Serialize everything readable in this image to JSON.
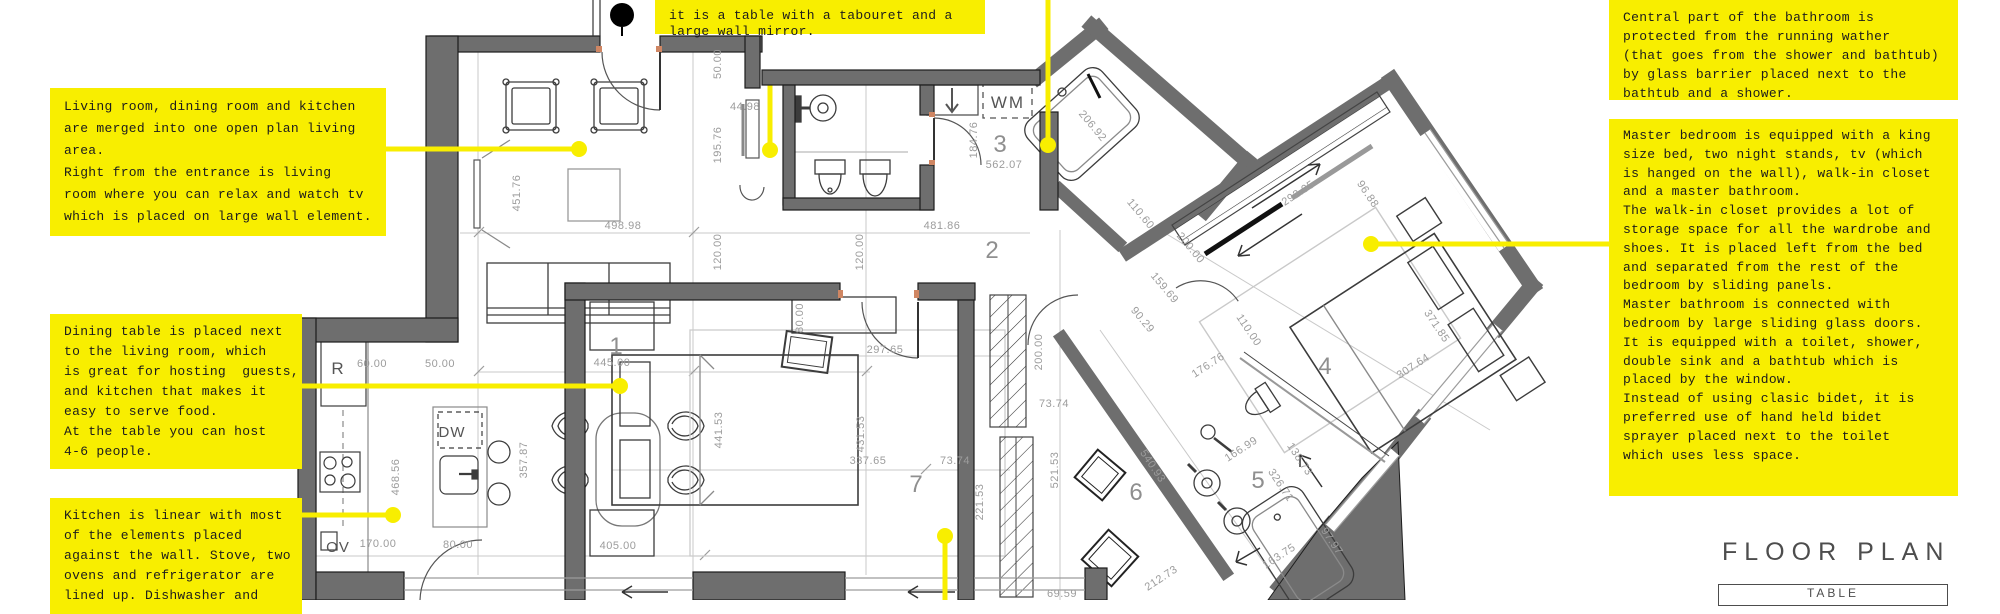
{
  "title": {
    "heading": "FLOOR PLAN",
    "table_header": "TABLE"
  },
  "colors": {
    "note_yellow": "#f8ee00",
    "wall_gray": "#6e6e6e",
    "dim_gray": "#9c9c9c",
    "line_dark": "#1c1c1c"
  },
  "notes": [
    {
      "id": "note-entrance",
      "x": 655,
      "y": 0,
      "w": 330,
      "h": 34,
      "lh": 16,
      "lines": [
        "it is a table with a tabouret and a",
        "large wall mirror."
      ]
    },
    {
      "id": "note-bathroom-glass",
      "x": 1609,
      "y": 0,
      "w": 349,
      "h": 100,
      "lh": 19,
      "lines": [
        "Central part of the bathroom is",
        "protected from the running wather",
        "(that goes from the shower and bathtub)",
        "by glass barrier placed next to the",
        "bathtub and a shower."
      ]
    },
    {
      "id": "note-living-room",
      "x": 50,
      "y": 88,
      "w": 336,
      "h": 148,
      "lh": 22,
      "lines": [
        "Living room, dining room and kitchen",
        "are merged into one open plan living",
        "area.",
        "Right from the entrance is living",
        "room where you can relax and watch tv",
        "which is placed on large wall element."
      ]
    },
    {
      "id": "note-dining-table",
      "x": 50,
      "y": 314,
      "w": 252,
      "h": 155,
      "lh": 20,
      "lines": [
        "Dining table is placed next",
        "to the living room, which",
        "is great for hosting  guests,",
        "and kitchen that makes it",
        "easy to serve food.",
        "At the table you can host",
        "4-6 people."
      ]
    },
    {
      "id": "note-kitchen",
      "x": 50,
      "y": 498,
      "w": 252,
      "h": 116,
      "lh": 20,
      "lines": [
        "Kitchen is linear with most",
        "of the elements placed",
        "against the wall. Stove, two",
        "ovens and refrigerator are",
        "lined up. Dishwasher and"
      ]
    },
    {
      "id": "note-master-bedroom",
      "x": 1609,
      "y": 119,
      "w": 349,
      "h": 377,
      "lh": 18.8,
      "lines": [
        "Master bedroom is equipped with a king",
        "size bed, two night stands, tv (which",
        "is hanged on the wall), walk-in closet",
        "and a master bathroom.",
        "The walk-in closet provides a lot of",
        "storage space for all the wardrobe and",
        "shoes. It is placed left from the bed",
        "and separated from the rest of the",
        "bedroom by sliding panels.",
        "Master bathroom is connected with",
        "bedroom by large sliding glass doors.",
        "It is equipped with a toilet, shower,",
        "double sink and a bathtub which is",
        "placed by the window.",
        "Instead of using clasic bidet, it is",
        "preferred use of hand held bidet",
        "sprayer placed next to the toilet",
        "which uses less space."
      ]
    }
  ],
  "callouts": [
    {
      "id": "callout-living",
      "x1": 386,
      "y1": 149,
      "x2": 579,
      "y2": 149,
      "dot": "end",
      "layer": "over"
    },
    {
      "id": "callout-entrance",
      "x1": 770,
      "y1": 80,
      "x2": 770,
      "y2": 150,
      "dot": "end",
      "layer": "under"
    },
    {
      "id": "callout-bathtub",
      "x1": 1048,
      "y1": 0,
      "x2": 1048,
      "y2": 145,
      "dot": "end",
      "layer": "over"
    },
    {
      "id": "callout-dining",
      "x1": 302,
      "y1": 386,
      "x2": 620,
      "y2": 386,
      "dot": "end",
      "layer": "over"
    },
    {
      "id": "callout-kitchen",
      "x1": 302,
      "y1": 515,
      "x2": 393,
      "y2": 515,
      "dot": "end",
      "layer": "over"
    },
    {
      "id": "callout-master",
      "x1": 1609,
      "y1": 244,
      "x2": 1371,
      "y2": 244,
      "dot": "end",
      "layer": "over"
    },
    {
      "id": "callout-bedroom7",
      "x1": 945,
      "y1": 600,
      "x2": 945,
      "y2": 536,
      "dot": "end",
      "layer": "over"
    }
  ],
  "dimensions": [
    {
      "t": "50.00",
      "x": 721,
      "y": 64,
      "r": -90
    },
    {
      "t": "44.98",
      "x": 745,
      "y": 110,
      "r": 0
    },
    {
      "t": "195.76",
      "x": 721,
      "y": 145,
      "r": -90
    },
    {
      "t": "451.76",
      "x": 520,
      "y": 193,
      "r": -90
    },
    {
      "t": "498.98",
      "x": 623,
      "y": 229,
      "r": 0
    },
    {
      "t": "481.86",
      "x": 942,
      "y": 229,
      "r": 0
    },
    {
      "t": "120.00",
      "x": 721,
      "y": 252,
      "r": -90
    },
    {
      "t": "120.00",
      "x": 863,
      "y": 252,
      "r": -90
    },
    {
      "t": "184.76",
      "x": 977,
      "y": 140,
      "r": -90
    },
    {
      "t": "562.07",
      "x": 1004,
      "y": 168,
      "r": 0
    },
    {
      "t": "206.92",
      "x": 1090,
      "y": 128,
      "r": 50
    },
    {
      "t": "60.00",
      "x": 372,
      "y": 367,
      "r": 0
    },
    {
      "t": "50.00",
      "x": 440,
      "y": 367,
      "r": 0
    },
    {
      "t": "445.00",
      "x": 612,
      "y": 366,
      "r": 0
    },
    {
      "t": "468.56",
      "x": 399,
      "y": 477,
      "r": -90
    },
    {
      "t": "357.87",
      "x": 527,
      "y": 460,
      "r": -90
    },
    {
      "t": "170.00",
      "x": 378,
      "y": 547,
      "r": 0
    },
    {
      "t": "80.00",
      "x": 458,
      "y": 548,
      "r": 0
    },
    {
      "t": "405.00",
      "x": 618,
      "y": 549,
      "r": 0
    },
    {
      "t": "80.00",
      "x": 803,
      "y": 318,
      "r": -90
    },
    {
      "t": "297.65",
      "x": 885,
      "y": 353,
      "r": 0
    },
    {
      "t": "441.53",
      "x": 722,
      "y": 430,
      "r": -90
    },
    {
      "t": "431.53",
      "x": 864,
      "y": 434,
      "r": -90
    },
    {
      "t": "337.65",
      "x": 868,
      "y": 464,
      "r": 0
    },
    {
      "t": "73.74",
      "x": 955,
      "y": 464,
      "r": 0
    },
    {
      "t": "73.74",
      "x": 1054,
      "y": 407,
      "r": 0
    },
    {
      "t": "221.53",
      "x": 983,
      "y": 502,
      "r": -90
    },
    {
      "t": "521.53",
      "x": 1058,
      "y": 470,
      "r": -90
    },
    {
      "t": "200.00",
      "x": 1042,
      "y": 352,
      "r": -90
    },
    {
      "t": "69.59",
      "x": 1062,
      "y": 597,
      "r": 0
    },
    {
      "t": "110.60",
      "x": 1138,
      "y": 216,
      "r": 50
    },
    {
      "t": "200.00",
      "x": 1188,
      "y": 250,
      "r": 50
    },
    {
      "t": "159.69",
      "x": 1162,
      "y": 290,
      "r": 50
    },
    {
      "t": "90.29",
      "x": 1140,
      "y": 322,
      "r": 50
    },
    {
      "t": "176.76",
      "x": 1210,
      "y": 368,
      "r": -33
    },
    {
      "t": "110.00",
      "x": 1246,
      "y": 332,
      "r": 56
    },
    {
      "t": "292.95",
      "x": 1300,
      "y": 196,
      "r": -33
    },
    {
      "t": "96.88",
      "x": 1365,
      "y": 196,
      "r": 56
    },
    {
      "t": "371.85",
      "x": 1434,
      "y": 328,
      "r": 56
    },
    {
      "t": "307.64",
      "x": 1415,
      "y": 369,
      "r": -33
    },
    {
      "t": "540.93",
      "x": 1150,
      "y": 468,
      "r": 56
    },
    {
      "t": "166.99",
      "x": 1243,
      "y": 452,
      "r": -33
    },
    {
      "t": "138.73",
      "x": 1297,
      "y": 461,
      "r": 56
    },
    {
      "t": "326.71",
      "x": 1278,
      "y": 487,
      "r": 56
    },
    {
      "t": "97.97",
      "x": 1329,
      "y": 543,
      "r": 56
    },
    {
      "t": "163.75",
      "x": 1281,
      "y": 559,
      "r": -33
    },
    {
      "t": "212.73",
      "x": 1163,
      "y": 581,
      "r": -33
    }
  ],
  "rooms": [
    {
      "n": "1",
      "x": 616,
      "y": 354
    },
    {
      "n": "2",
      "x": 992,
      "y": 258
    },
    {
      "n": "3",
      "x": 1000,
      "y": 152
    },
    {
      "n": "4",
      "x": 1325,
      "y": 374
    },
    {
      "n": "5",
      "x": 1258,
      "y": 488
    },
    {
      "n": "6",
      "x": 1136,
      "y": 500
    },
    {
      "n": "7",
      "x": 916,
      "y": 492
    }
  ],
  "plan_labels": [
    {
      "t": "R",
      "x": 338,
      "y": 374,
      "fs": 17,
      "ls": 1
    },
    {
      "t": "DW",
      "x": 452,
      "y": 437,
      "fs": 15,
      "ls": 1
    },
    {
      "t": "OV",
      "x": 338,
      "y": 552,
      "fs": 15,
      "ls": 1
    },
    {
      "t": "WM",
      "x": 1008,
      "y": 108,
      "fs": 17,
      "ls": 2
    }
  ]
}
